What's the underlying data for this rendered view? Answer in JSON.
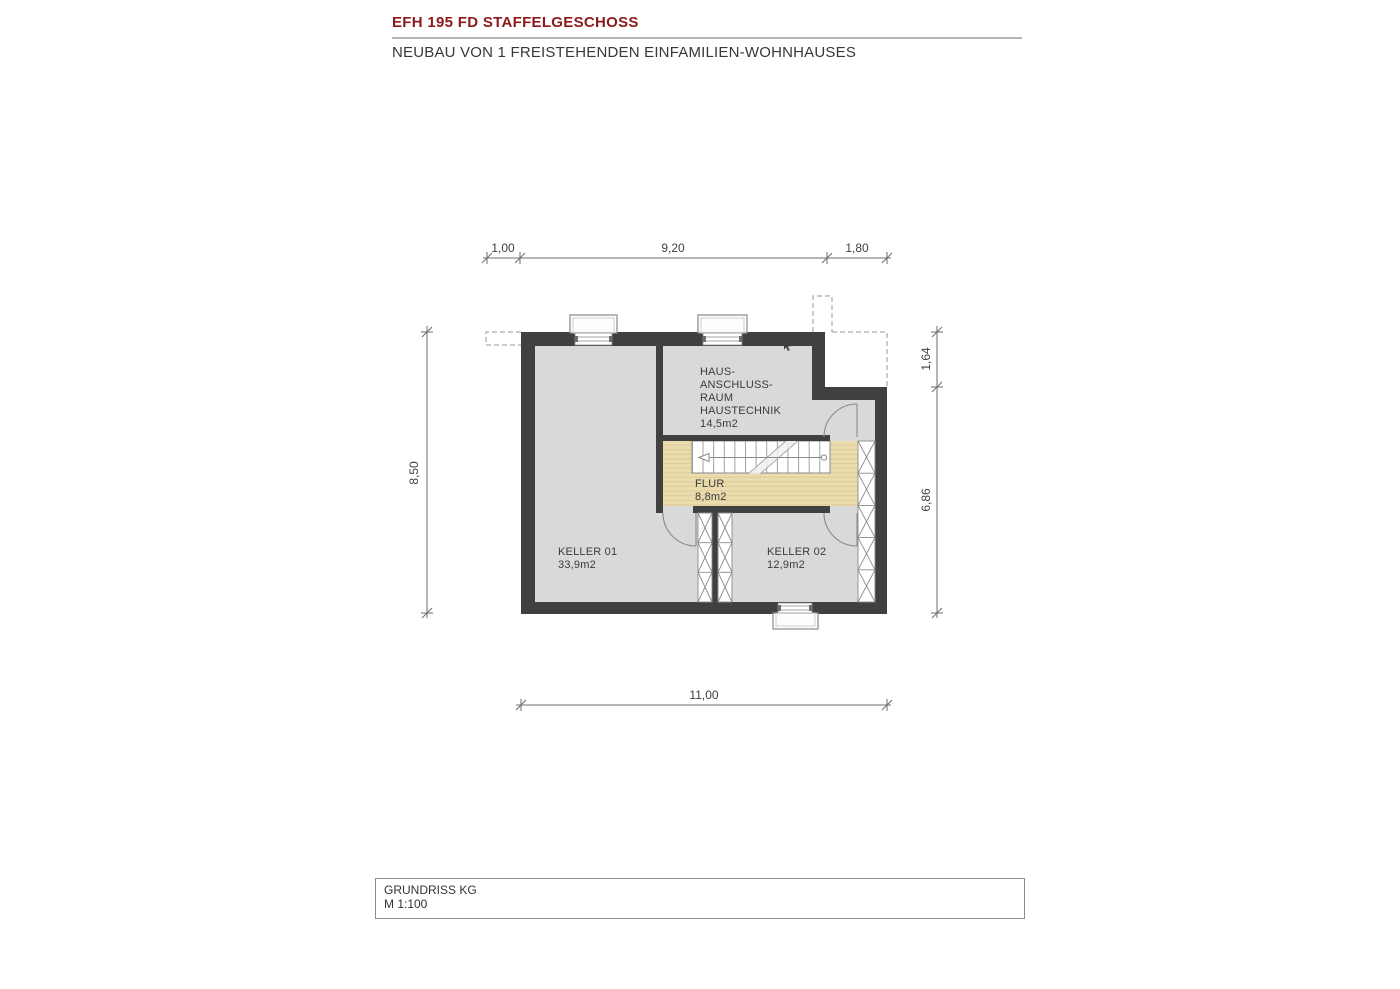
{
  "header": {
    "title": "EFH 195 FD STAFFELGESCHOSS",
    "subtitle": "NEUBAU VON 1 FREISTEHENDEN EINFAMILIEN-WOHNHAUSES"
  },
  "plan": {
    "rooms": {
      "haustechnik": {
        "label_line1": "HAUS-",
        "label_line2": "ANSCHLUSS-",
        "label_line3": "RAUM",
        "label_line4": "HAUSTECHNIK",
        "area": "14,5m2"
      },
      "flur": {
        "name": "FLUR",
        "area": "8,8m2"
      },
      "keller01": {
        "name": "KELLER 01",
        "area": "33,9m2"
      },
      "keller02": {
        "name": "KELLER 02",
        "area": "12,9m2"
      }
    },
    "dimensions": {
      "top_left": "1,00",
      "top_middle": "9,20",
      "top_right": "1,80",
      "left": "8,50",
      "right_upper": "1,64",
      "right_lower": "6,86",
      "bottom": "11,00"
    }
  },
  "footer": {
    "drawing_title": "GRUNDRISS KG",
    "scale": "M 1:100"
  },
  "colors": {
    "title_red": "#8B1B1B",
    "wall_dark": "#404040",
    "room_fill": "#D9D9D9",
    "floor_wood": "#EBDCAE",
    "floor_wood_stripe": "#DECB97",
    "drawing_line_gray": "#8A8A8A",
    "dimension_gray": "#666666"
  }
}
